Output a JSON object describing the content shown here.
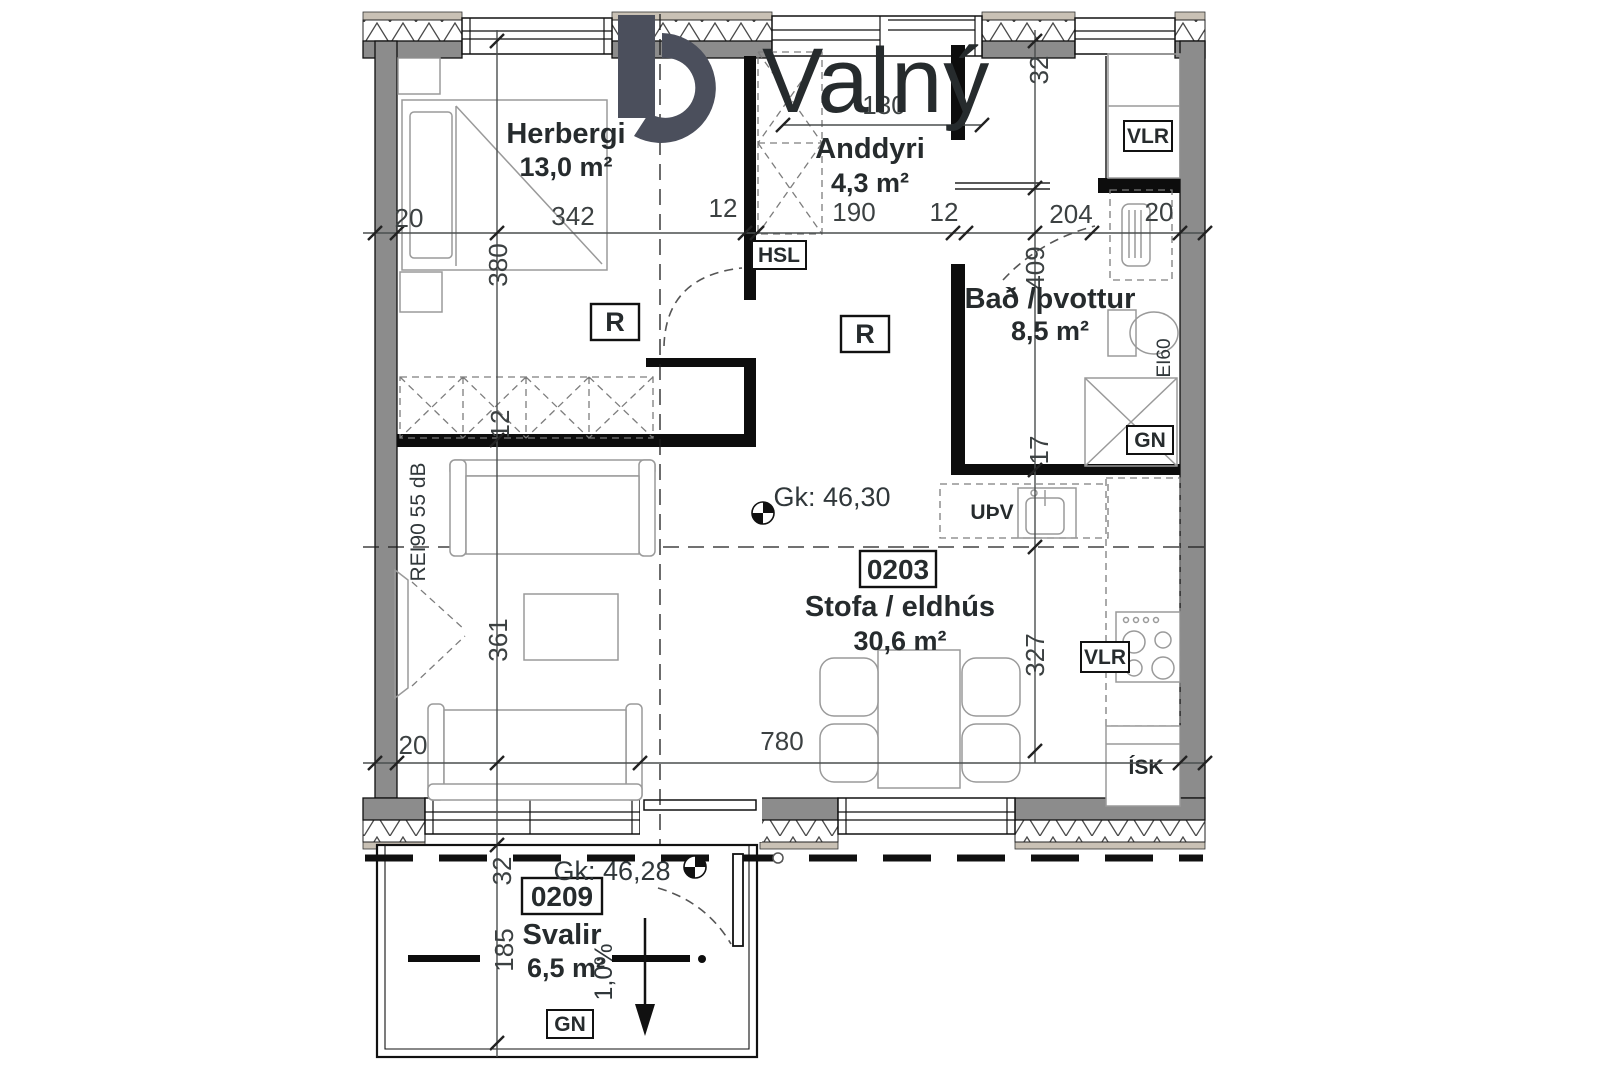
{
  "logo": {
    "brand": "Valný"
  },
  "rooms": {
    "herbergi": {
      "name": "Herbergi",
      "area": "13,0 m²"
    },
    "anddyri": {
      "name": "Anddyri",
      "area": "4,3 m²"
    },
    "bad": {
      "name": "Bað /þvottur",
      "area": "8,5 m²"
    },
    "stofa": {
      "name": "Stofa / eldhús",
      "area": "30,6 m²",
      "unit": "0203"
    },
    "svalir": {
      "name": "Svalir",
      "area": "6,5 m²",
      "unit": "0209"
    }
  },
  "levels": {
    "main": "Gk: 46,30",
    "balcony": "Gk: 46,28",
    "slope": "1,0%"
  },
  "tags": {
    "hsl": "HSL",
    "r": "R",
    "vlr": "VLR",
    "gn": "GN",
    "upv": "UÞV",
    "isk": "ÍSK",
    "ei60": "EI60",
    "fire_rating": "REI90 55 dB"
  },
  "dims": {
    "top": [
      "20",
      "342",
      "12",
      "190",
      "12",
      "204",
      "20"
    ],
    "window": "130",
    "left": [
      "380",
      "12",
      "361"
    ],
    "right": [
      "32",
      "409",
      "17",
      "327"
    ],
    "bottom": [
      "20",
      "780"
    ],
    "balcony": [
      "32",
      "185"
    ]
  },
  "colors": {
    "wall": "#8c8c8c",
    "band": "#c9c1b5",
    "logo": "#4b4f5c",
    "ink": "#23282a"
  }
}
